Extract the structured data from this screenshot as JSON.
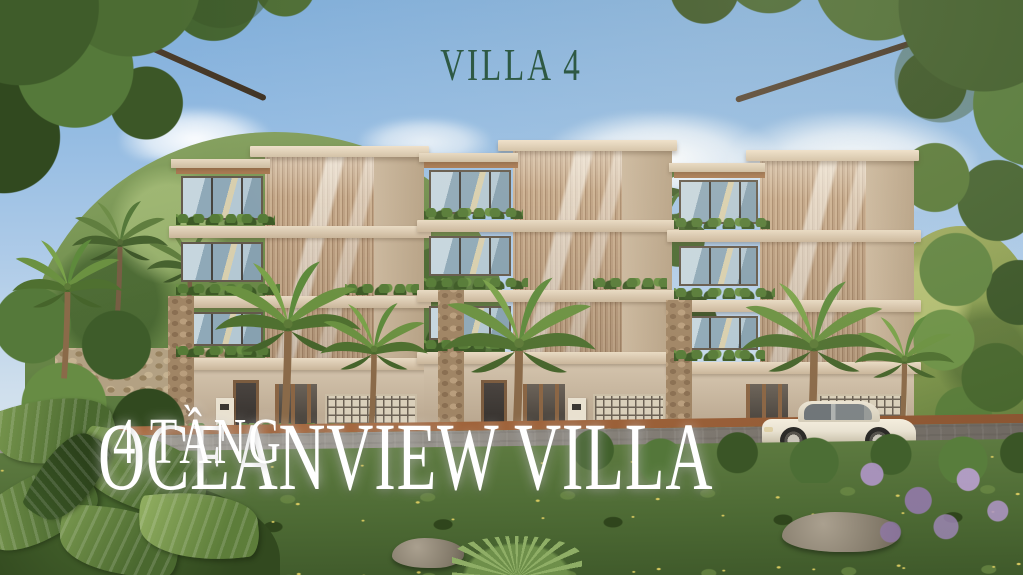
{
  "overlay": {
    "top_title": "VILLA 4",
    "main_title": "OCEANVIEW VILLA",
    "main_title_suffix": "4 TẦNG"
  },
  "palette": {
    "sky_top": "#7fadd9",
    "sky_horizon": "#dde8ef",
    "foliage_dark": "#3c5527",
    "foliage_mid": "#5d7d3f",
    "foliage_light": "#87a45b",
    "villa_concrete": "#d8c9b2",
    "wood_louver": "#c2a585",
    "window_glass": "#9fb9c9",
    "stone_cladding": "#a08565",
    "road_asphalt": "#8f8b85",
    "curb_terracotta": "#a4653c",
    "grass": "#4d6a34",
    "purple_flowers": "#a98bc0",
    "car_body": "#e9e2d1",
    "top_title_color": "#2e5944",
    "main_title_color": "#ffffff"
  }
}
